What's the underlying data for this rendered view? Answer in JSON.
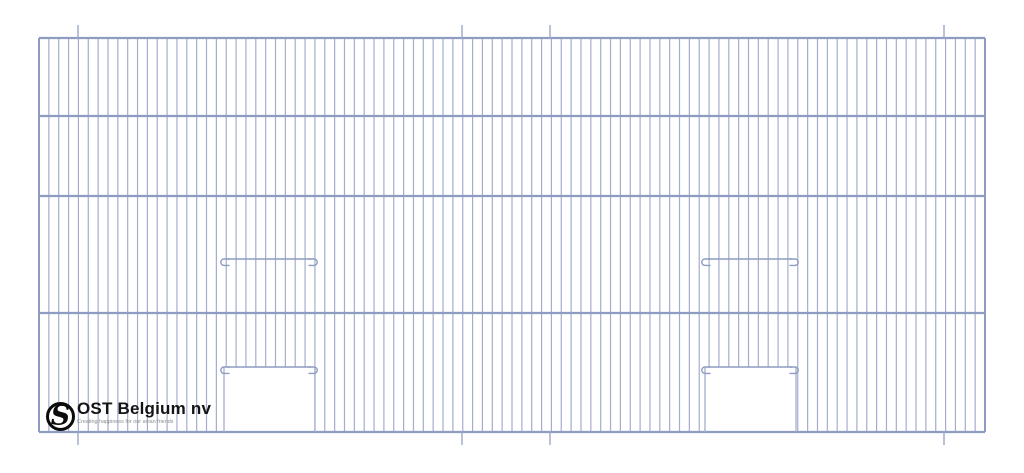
{
  "logo": {
    "company": "OST Belgium nv",
    "tagline": "Creating happiness for our avian friends",
    "monogram_letter": "S",
    "colors": {
      "ring": "#0b0b0b",
      "text": "#141414",
      "tagline": "#8d8d8d"
    }
  },
  "drawing": {
    "type": "technical-line-drawing",
    "subject": "wire-mesh cage front panel with two vertical sliding doors",
    "canvas": {
      "width": 1024,
      "height": 473,
      "background": "#ffffff"
    },
    "colors": {
      "wire": "#a3aecb",
      "rail": "#8d9cc0",
      "hook": "#8d9cc0",
      "tick": "#9aa8c6"
    },
    "frame": {
      "x1": 39,
      "y1": 38,
      "x2": 985,
      "y2": 432
    },
    "rail_ys": [
      116,
      196,
      313
    ],
    "wire_count": 97,
    "tick_xs": [
      78,
      462,
      550,
      944
    ],
    "tick_len": 13,
    "doors": [
      {
        "hook_x1": 220,
        "hook_x2": 318,
        "open_x1": 224,
        "open_x2": 315,
        "slide_y": 259,
        "sill_y": 367
      },
      {
        "hook_x1": 701,
        "hook_x2": 799,
        "open_x1": 705,
        "open_x2": 796,
        "slide_y": 259,
        "sill_y": 367
      }
    ]
  }
}
